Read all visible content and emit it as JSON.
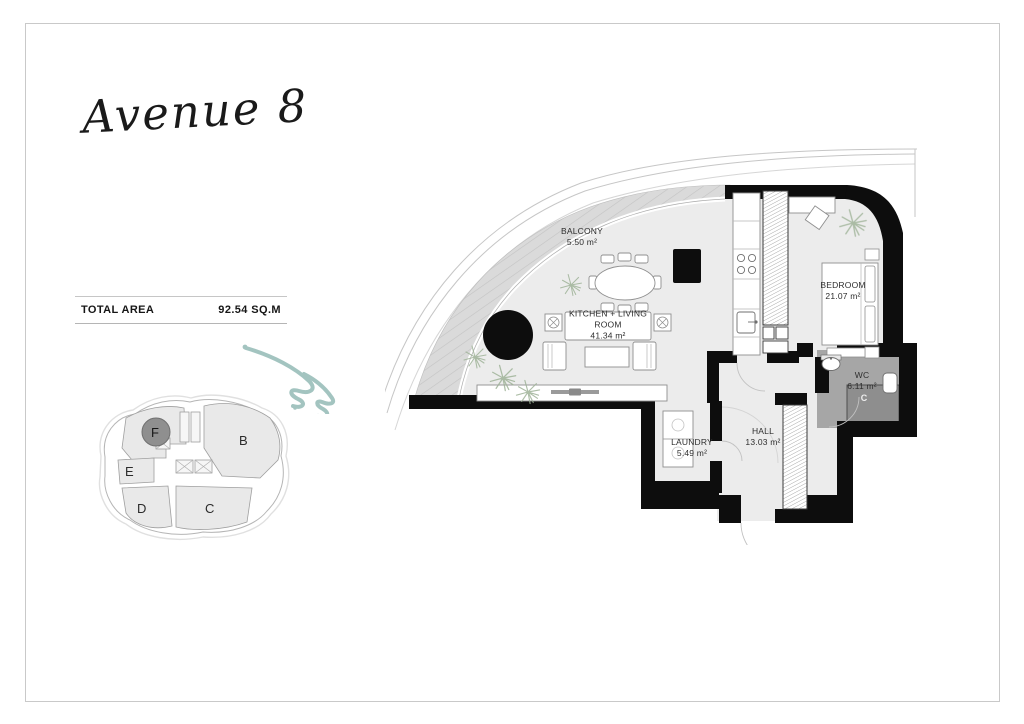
{
  "logo": {
    "text": "Avenue 8"
  },
  "summary": {
    "label": "TOTAL AREA",
    "value": "92.54 SQ.M"
  },
  "key_plan": {
    "units": [
      {
        "id": "B",
        "highlighted": false
      },
      {
        "id": "C",
        "highlighted": false
      },
      {
        "id": "D",
        "highlighted": false
      },
      {
        "id": "E",
        "highlighted": false
      },
      {
        "id": "F",
        "highlighted": true
      }
    ],
    "highlight_color": "#8f8f8f"
  },
  "floor_plan": {
    "rooms": [
      {
        "name": "BALCONY",
        "area": "5.50 m²"
      },
      {
        "name": "KITCHEN + LIVING ROOM",
        "area": "41.34 m²"
      },
      {
        "name": "BEDROOM",
        "area": "21.07 m²"
      },
      {
        "name": "WC",
        "area": "6.11 m²"
      },
      {
        "name": "LAUNDRY",
        "area": "5.49 m²"
      },
      {
        "name": "HALL",
        "area": "13.03 m²"
      }
    ],
    "watermark": "C",
    "colors": {
      "wall": "#0d0d0d",
      "floor": "#ececec",
      "balcony_floor": "#dadada",
      "wc_floor": "#a6a6a6",
      "shower_floor": "#8e8e8e",
      "plant": "#9fb398",
      "wave_accent": "#a3c4c0"
    }
  }
}
